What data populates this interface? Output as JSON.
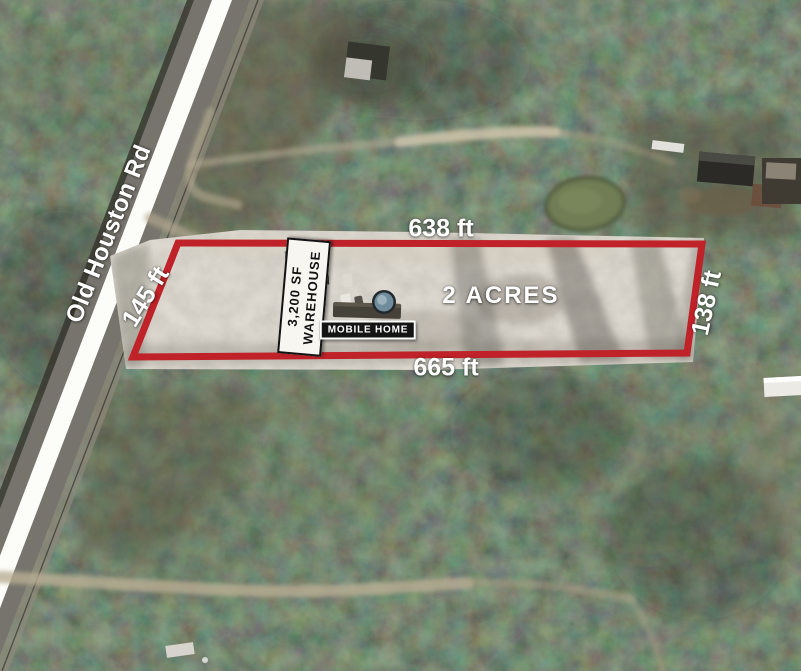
{
  "image": {
    "road_label": "Old Houston Rd",
    "area_label": "2 ACRES",
    "dimensions": {
      "top": "638 ft",
      "bottom": "665 ft",
      "left": "145 ft",
      "right": "138 ft"
    },
    "warehouse_label": {
      "line1": "3,200 SF",
      "line2": "WAREHOUSE"
    },
    "mobile_home_label": "MOBILE HOME",
    "colors": {
      "parcel_outline": "#bf2228",
      "dimension_text": "#ffffff",
      "warehouse_box_bg": "#f7f6f1",
      "warehouse_box_text": "#131313",
      "mobile_home_box_bg": "#141414",
      "mobile_home_box_text": "#ffffff",
      "road_stripe": "#fcfcf9"
    }
  }
}
